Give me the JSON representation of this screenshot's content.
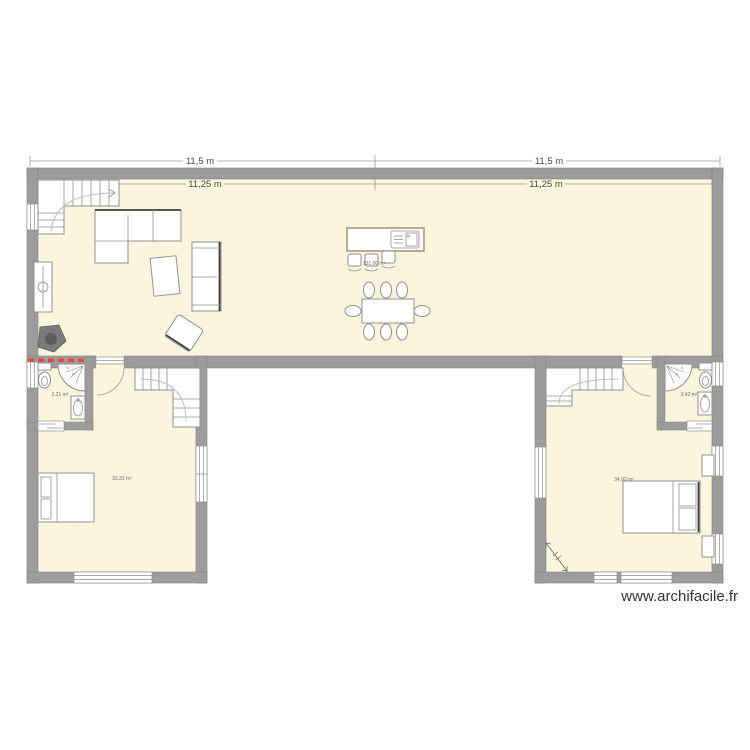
{
  "watermark": "www.archifacile.fr",
  "dimensions": {
    "top_left": "11,5 m",
    "top_right": "11,5 m",
    "inner_left": "11,25 m",
    "inner_right": "11,25 m"
  },
  "areas": {
    "living": "131,06 m²",
    "bath_left": "3,21 m²",
    "bedroom_left": "33,32 m²",
    "bath_right": "3,42 m²",
    "bedroom_right": "34,92 m²"
  },
  "symbols": [
    "staircase",
    "corner-sofa",
    "sofa",
    "armchair",
    "coffee-table",
    "tv-cabinet",
    "wood-stove",
    "kitchen-island",
    "sink-unit",
    "bar-stool",
    "dining-table",
    "dining-chair",
    "bed",
    "pillow",
    "nightstand",
    "toilet",
    "corner-shower",
    "washbasin",
    "door-swing",
    "sliding-door",
    "window",
    "red-dash-marker",
    "diagonal-arrow"
  ],
  "colors": {
    "background": "#ffffff",
    "room_fill": "#fbf5dd",
    "wall_fill": "#9c9c9c",
    "wall_edge": "#828282",
    "furniture_stroke": "#8f8f8f",
    "furniture_dark": "#3f3f3f",
    "window_line": "#8f8f8f",
    "walkline": "#bdbdbd",
    "door_arc": "#a5a5a5",
    "red_marker": "#e8453c",
    "dim_line": "#9a9a9a",
    "dim_text": "#4a4a4a",
    "area_text": "#6e6e6e",
    "watermark_color": "#333333",
    "island_stroke": "#a39b7d",
    "stove_fill": "#7a7a7a",
    "stove_dark": "#5e5e5e"
  }
}
